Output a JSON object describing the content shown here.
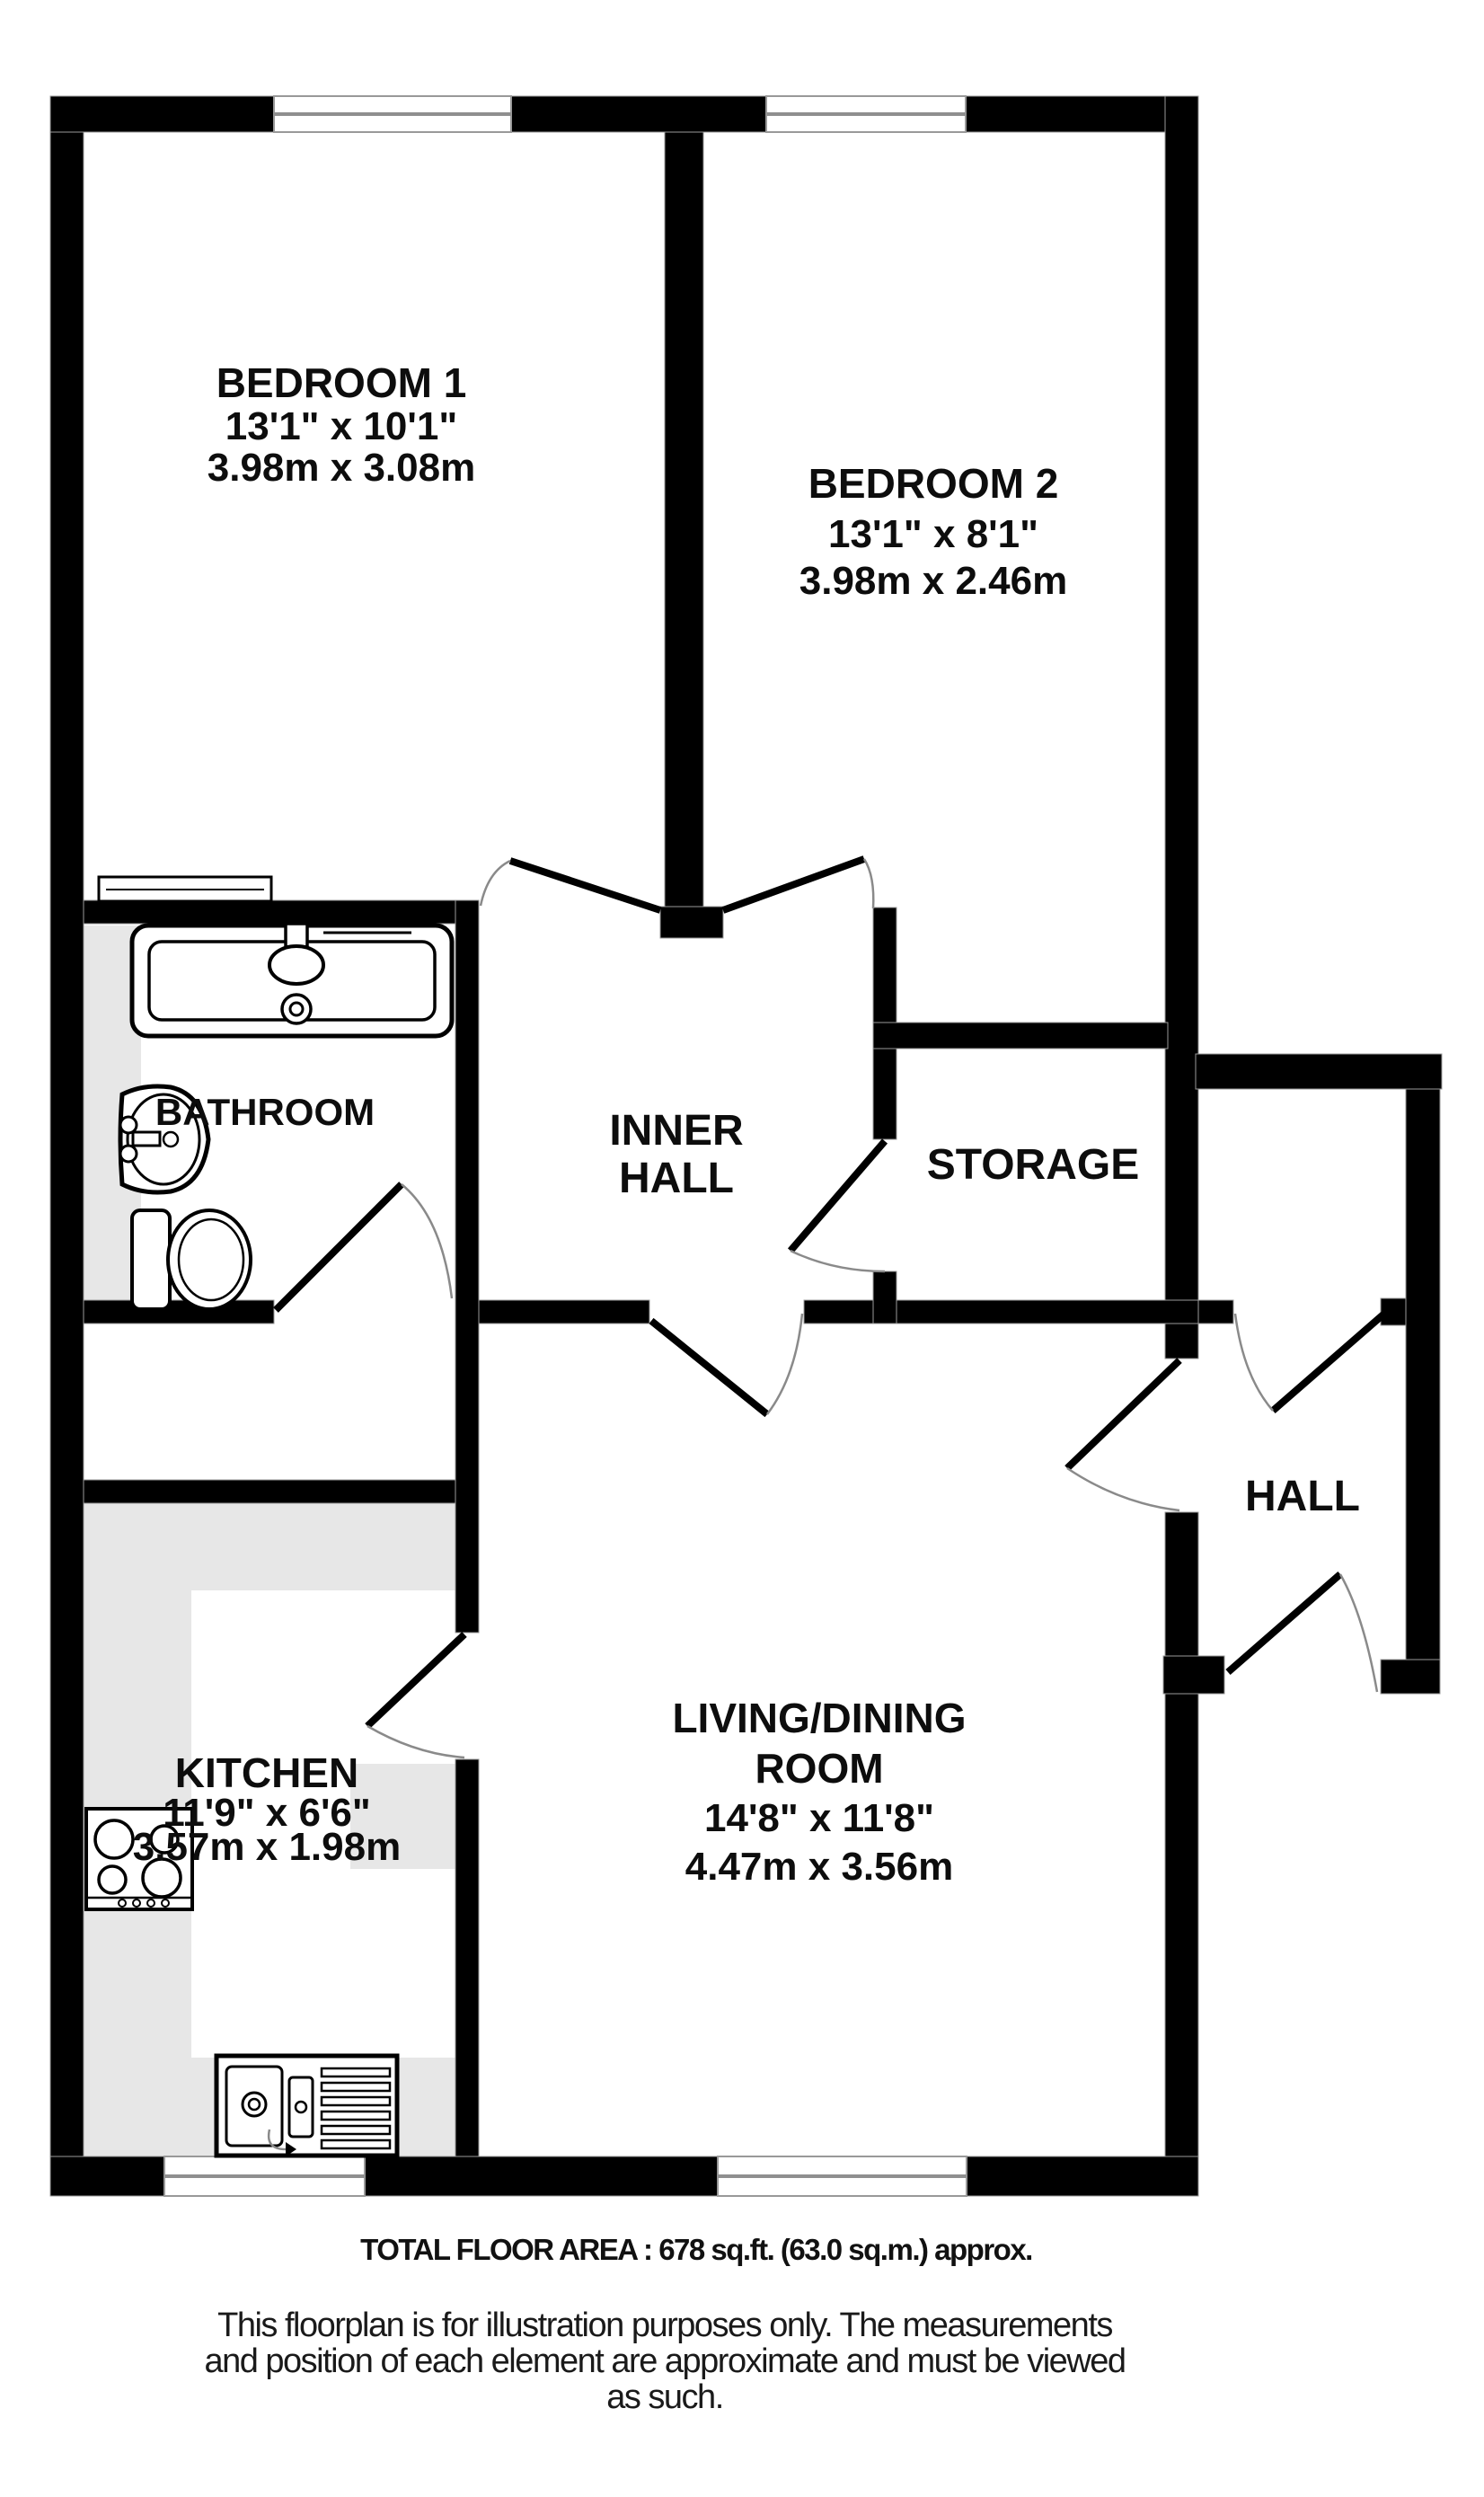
{
  "rooms": {
    "bedroom1": {
      "name": "BEDROOM 1",
      "imperial": "13'1\"  x 10'1\"",
      "metric": "3.98m  x 3.08m"
    },
    "bedroom2": {
      "name": "BEDROOM 2",
      "imperial": "13'1\"  x 8'1\"",
      "metric": "3.98m  x 2.46m"
    },
    "bathroom": {
      "name": "BATHROOM"
    },
    "inner_hall": {
      "line1": "INNER",
      "line2": "HALL"
    },
    "storage": {
      "name": "STORAGE"
    },
    "hall": {
      "name": "HALL"
    },
    "kitchen": {
      "name": "KITCHEN",
      "imperial": "11'9\"  x 6'6\"",
      "metric": "3.57m  x 1.98m"
    },
    "living": {
      "line1": "LIVING/DINING",
      "line2": "ROOM",
      "imperial": "14'8\"  x 11'8\"",
      "metric": "4.47m  x 3.56m"
    }
  },
  "footer": {
    "total": "TOTAL FLOOR AREA : 678 sq.ft. (63.0 sq.m.) approx.",
    "disc1": "This floorplan is for illustration purposes only. The measurements",
    "disc2": "and position of each element are approximate and must be viewed",
    "disc3": "as such."
  },
  "colors": {
    "wall": "#000000",
    "counter": "#e7e7e7",
    "door_arc": "#8a8a8a"
  }
}
